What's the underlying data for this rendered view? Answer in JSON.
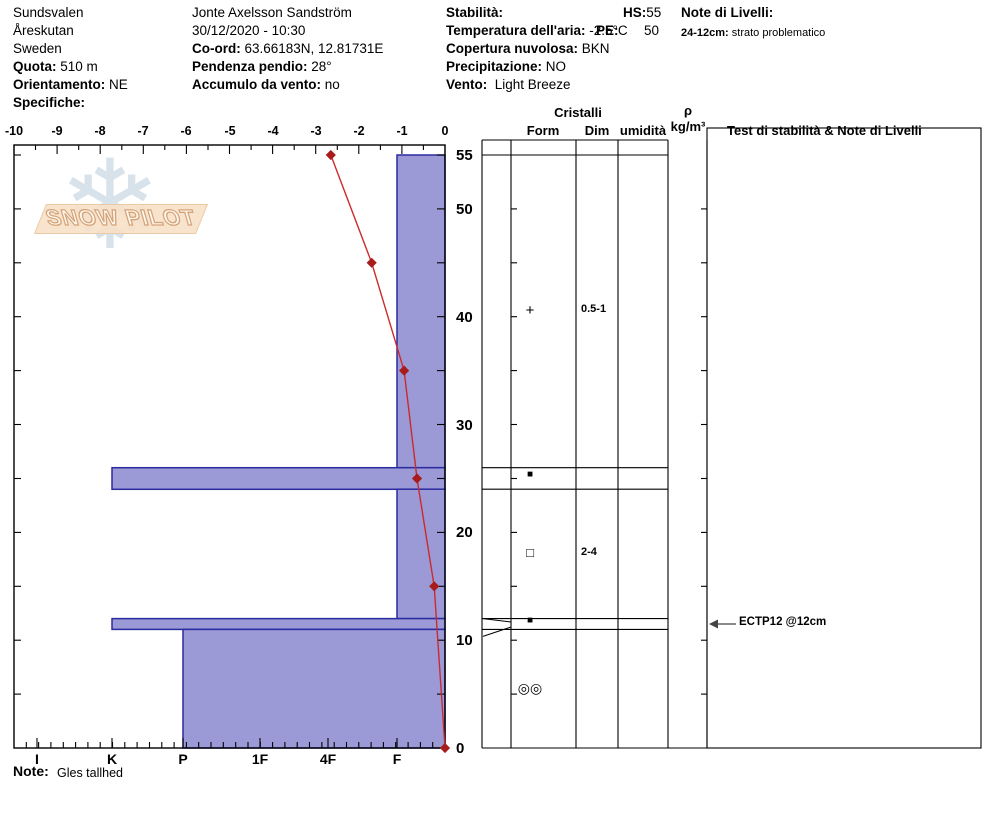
{
  "header": {
    "col1": [
      {
        "b": "",
        "t": "Sundsvalen"
      },
      {
        "b": "",
        "t": "Åreskutan"
      },
      {
        "b": "",
        "t": "Sweden"
      },
      {
        "b": "Quota:",
        "t": " 510 m"
      },
      {
        "b": "Orientamento:",
        "t": " NE"
      },
      {
        "b": "Specifiche:",
        "t": ""
      }
    ],
    "col2": [
      {
        "b": "",
        "t": "Jonte Axelsson Sandström"
      },
      {
        "b": "",
        "t": "30/12/2020 - 10:30"
      },
      {
        "b": "Co-ord:",
        "t": " 63.66183N, 12.81731E"
      },
      {
        "b": "Pendenza pendio:",
        "t": " 28°"
      },
      {
        "b": "Accumulo da vento:",
        "t": " no"
      }
    ],
    "col3": [
      {
        "b": "Stabilità:",
        "t": ""
      },
      {
        "b": "Temperatura dell'aria:",
        "t": " -2.5°C"
      },
      {
        "b": "Copertura nuvolosa:",
        "t": " BKN"
      },
      {
        "b": "Precipitazione:",
        "t": " NO"
      },
      {
        "b": "Vento:",
        "t": "  Light Breeze"
      }
    ],
    "hs_label": "HS:",
    "hs_value": "55",
    "pe_label": "PE:",
    "pe_value": "50",
    "levels_title": "Note di Livelli:",
    "levels_line_label": "24-12cm:",
    "levels_line_text": " strato problematico"
  },
  "logo": {
    "text": "SNOW PILOT",
    "snowflake": "❄"
  },
  "axes": {
    "top_labels": [
      "-10",
      "-9",
      "-8",
      "-7",
      "-6",
      "-5",
      "-4",
      "-3",
      "-2",
      "-1",
      "0"
    ],
    "y_labels": [
      "55",
      "50",
      "40",
      "30",
      "20",
      "10",
      "0"
    ],
    "hardness_labels": [
      "I",
      "K",
      "P",
      "1F",
      "4F",
      "F"
    ]
  },
  "table_headers": {
    "cristalli": "Cristalli",
    "form": "Form",
    "dim": "Dim",
    "umidita": "umidità",
    "rho": "ρ",
    "rho_unit": "kg/m³",
    "test": "Test di stabilità & Note di Livelli"
  },
  "footer": {
    "note_label": "Note:",
    "note_text": "Gles tallhed"
  },
  "chart_data": {
    "type": "bar",
    "subtype": "snow-profile",
    "title": "SnowPilot snow pit profile",
    "height_axis": {
      "label": "height above ground (cm)",
      "range": [
        0,
        55
      ],
      "tick_step": 5,
      "labeled_ticks": [
        55,
        50,
        40,
        30,
        20,
        10,
        0
      ]
    },
    "temperature_axis": {
      "label": "snow temperature (°C)",
      "range": [
        -10,
        0
      ],
      "tick_step": 1
    },
    "hardness_axis": {
      "labels": [
        "I",
        "K",
        "P",
        "1F",
        "4F",
        "F"
      ]
    },
    "layers": [
      {
        "top_cm": 55,
        "bottom_cm": 26,
        "hardness": "F",
        "grain_form_symbol": "+",
        "grain_form": "precipitation-particles",
        "grain_size_mm": "0.5-1",
        "flagged": false
      },
      {
        "top_cm": 26,
        "bottom_cm": 24,
        "hardness": "K",
        "grain_form_symbol": "■",
        "grain_form": "ice-crust-filled-square",
        "grain_size_mm": "",
        "flagged": false
      },
      {
        "top_cm": 24,
        "bottom_cm": 12,
        "hardness": "F",
        "grain_form_symbol": "□",
        "grain_form": "faceted-crystals",
        "grain_size_mm": "2-4",
        "flagged": false
      },
      {
        "top_cm": 12,
        "bottom_cm": 11,
        "hardness": "K",
        "grain_form_symbol": "■",
        "grain_form": "ice-crust-filled-square",
        "grain_size_mm": "",
        "flagged": true
      },
      {
        "top_cm": 11,
        "bottom_cm": 0,
        "hardness": "P",
        "grain_form_symbol": "◎◎",
        "grain_form": "melt-freeze-crust",
        "grain_size_mm": "",
        "flagged": false
      }
    ],
    "temperature_series": {
      "name": "snow temperature profile",
      "points": [
        {
          "t": -2.65,
          "h": 55
        },
        {
          "t": -1.7,
          "h": 45
        },
        {
          "t": -0.95,
          "h": 35
        },
        {
          "t": -0.65,
          "h": 25
        },
        {
          "t": -0.25,
          "h": 15
        },
        {
          "t": 0,
          "h": 0
        }
      ]
    },
    "tests": [
      {
        "label": "ECTP12 @12cm",
        "at_layer_index": 3
      }
    ],
    "colors": {
      "bar_fill": "#9b9ad6",
      "bar_border": "#2b2ba0",
      "temp_line": "#cc2a2a",
      "temp_marker": "#a81c1c",
      "line_black": "#000000"
    }
  }
}
